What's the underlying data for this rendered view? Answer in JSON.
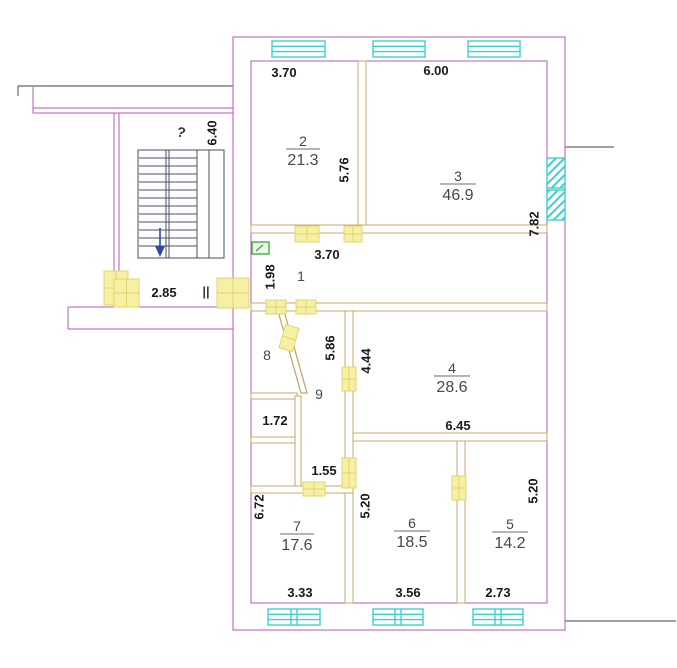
{
  "meta": {
    "type": "apartment-floor-plan"
  },
  "colors": {
    "outer_wall": "#b45ab4",
    "interior_wall": "#c4a86e",
    "window": "#3ecfcf",
    "door_marker": "#f6f0a6",
    "door_marker_line": "#e3d46a",
    "fixture": "#3aa63a",
    "stairs": "#4a4f66",
    "stair_arrow": "#3344aa",
    "dimension_text": "#1a1a1a",
    "room_text": "#474747",
    "reference_line": "#666677"
  },
  "rooms": [
    {
      "number": "1",
      "area": ""
    },
    {
      "number": "2",
      "area": "21.3"
    },
    {
      "number": "3",
      "area": "46.9"
    },
    {
      "number": "4",
      "area": "28.6"
    },
    {
      "number": "5",
      "area": "14.2"
    },
    {
      "number": "6",
      "area": "18.5"
    },
    {
      "number": "7",
      "area": "17.6"
    },
    {
      "number": "8",
      "area": ""
    },
    {
      "number": "9",
      "area": ""
    }
  ],
  "dimensions": {
    "room2_width": "3.70",
    "room3_width": "6.00",
    "room2_height": "5.76",
    "room3_height": "7.82",
    "stairwell_height": "6.40",
    "stairwell_note": "?",
    "annex_width": "2.85",
    "corridor_left_height": "1.98",
    "corridor_width": "3.70",
    "hall_height": "5.86",
    "room4_left_height": "4.44",
    "room4_width": "6.45",
    "niche_width": "1.72",
    "closet_width": "1.55",
    "room6_left_height": "5.20",
    "room5_right_height": "5.20",
    "room7_left_height": "6.72",
    "room7_width": "3.33",
    "room6_width": "3.56",
    "room5_width": "2.73"
  },
  "symbols": {
    "level_mark": "||"
  }
}
